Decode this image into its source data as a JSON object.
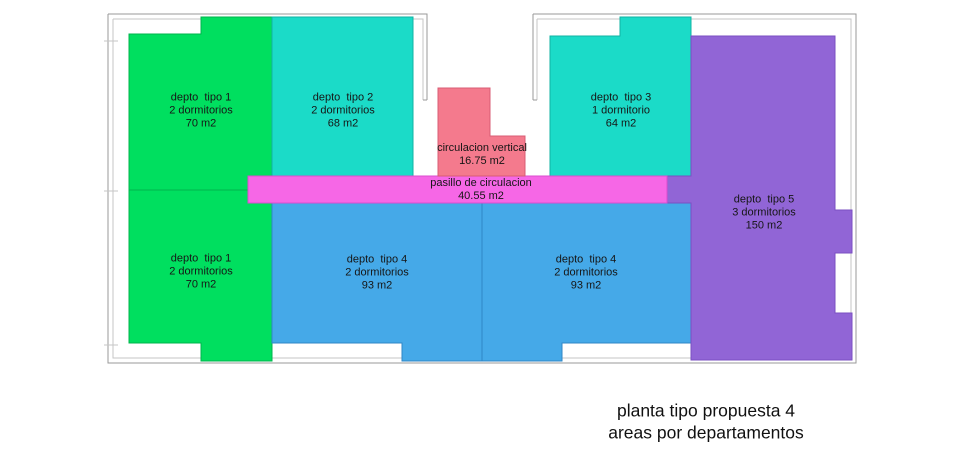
{
  "title": {
    "line1": "planta tipo propuesta 4",
    "line2": "areas por departamentos"
  },
  "colors": {
    "green": "#00df5f",
    "teal": "#1bdbc8",
    "blue": "#45a9e8",
    "purple": "#9165d6",
    "magenta": "#f667e6",
    "pink": "#f47a8d"
  },
  "rooms": {
    "depto1_upper": {
      "name": "depto  tipo 1",
      "bedrooms": "2 dormitorios",
      "area": "70 m2"
    },
    "depto1_lower": {
      "name": "depto  tipo 1",
      "bedrooms": "2 dormitorios",
      "area": "70 m2"
    },
    "depto2": {
      "name": "depto  tipo 2",
      "bedrooms": "2 dormitorios",
      "area": "68 m2"
    },
    "depto3": {
      "name": "depto  tipo 3",
      "bedrooms": "1 dormitorio",
      "area": "64 m2"
    },
    "depto4_left": {
      "name": "depto  tipo 4",
      "bedrooms": "2 dormitorios",
      "area": "93 m2"
    },
    "depto4_right": {
      "name": "depto  tipo 4",
      "bedrooms": "2 dormitorios",
      "area": "93 m2"
    },
    "depto5": {
      "name": "depto  tipo 5",
      "bedrooms": "3 dormitorios",
      "area": "150 m2"
    },
    "circulacion_vertical": {
      "name": "circulacion vertical",
      "area": "16.75 m2"
    },
    "pasillo": {
      "name": "pasillo de circulacion",
      "area": "40.55 m2"
    }
  }
}
